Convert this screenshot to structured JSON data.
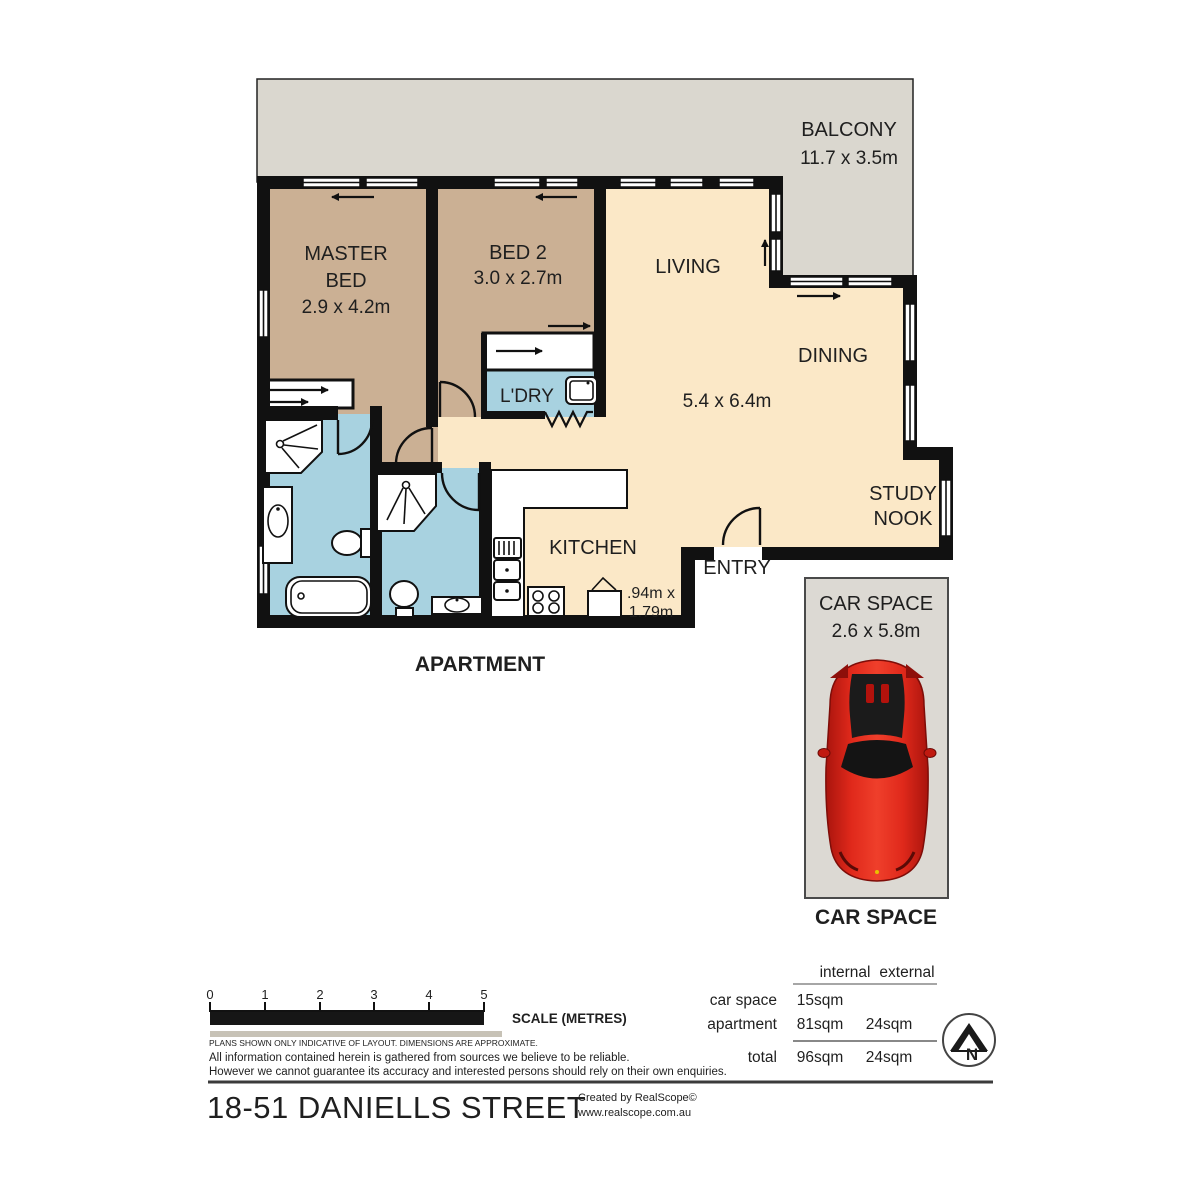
{
  "plan": {
    "balcony": {
      "name": "BALCONY",
      "dims": "11.7 x 3.5m"
    },
    "master": {
      "line1": "MASTER",
      "line2": "BED",
      "dims": "2.9 x 4.2m"
    },
    "bed2": {
      "name": "BED 2",
      "dims": "3.0 x 2.7m"
    },
    "living": {
      "name": "LIVING",
      "dims": "5.4 x 6.4m"
    },
    "dining": {
      "name": "DINING"
    },
    "ldry": {
      "name": "L'DRY"
    },
    "kitchen": {
      "name": "KITCHEN"
    },
    "entry": {
      "name": "ENTRY"
    },
    "study": {
      "line1": "STUDY",
      "line2": "NOOK"
    },
    "nook": {
      "line1": ".94m x",
      "line2": "1.79m"
    },
    "apartment_caption": "APARTMENT"
  },
  "car": {
    "title": "CAR SPACE",
    "dims": "2.6 x 5.8m",
    "caption": "CAR SPACE"
  },
  "scale": {
    "ticks": [
      "0",
      "1",
      "2",
      "3",
      "4",
      "5"
    ],
    "label": "SCALE (METRES)"
  },
  "notes": {
    "small": "PLANS SHOWN ONLY INDICATIVE OF LAYOUT.  DIMENSIONS ARE APPROXIMATE.",
    "line1": "All information contained herein is gathered from sources we believe to be reliable.",
    "line2": "However we cannot guarantee its accuracy and interested persons should rely on their own enquiries."
  },
  "table": {
    "header_internal": "internal",
    "header_external": "external",
    "rows": [
      {
        "label": "car space",
        "internal": "15sqm",
        "external": ""
      },
      {
        "label": "apartment",
        "internal": "81sqm",
        "external": "24sqm"
      },
      {
        "label": "total",
        "internal": "96sqm",
        "external": "24sqm"
      }
    ]
  },
  "compass": {
    "letter": "N"
  },
  "footer": {
    "title": "18-51 DANIELLS STREET",
    "credit1": "Created by RealScope©",
    "credit2": "www.realscope.com.au"
  },
  "colors": {
    "bedroom_tan": "#CBB094",
    "living_cream": "#FBE8C7",
    "wet_area_blue": "#A8D2E0",
    "balcony_grey": "#DAD7CF",
    "carspace_grey": "#DCD9D3",
    "wall_black": "#111111",
    "car_red": "#D42018"
  }
}
